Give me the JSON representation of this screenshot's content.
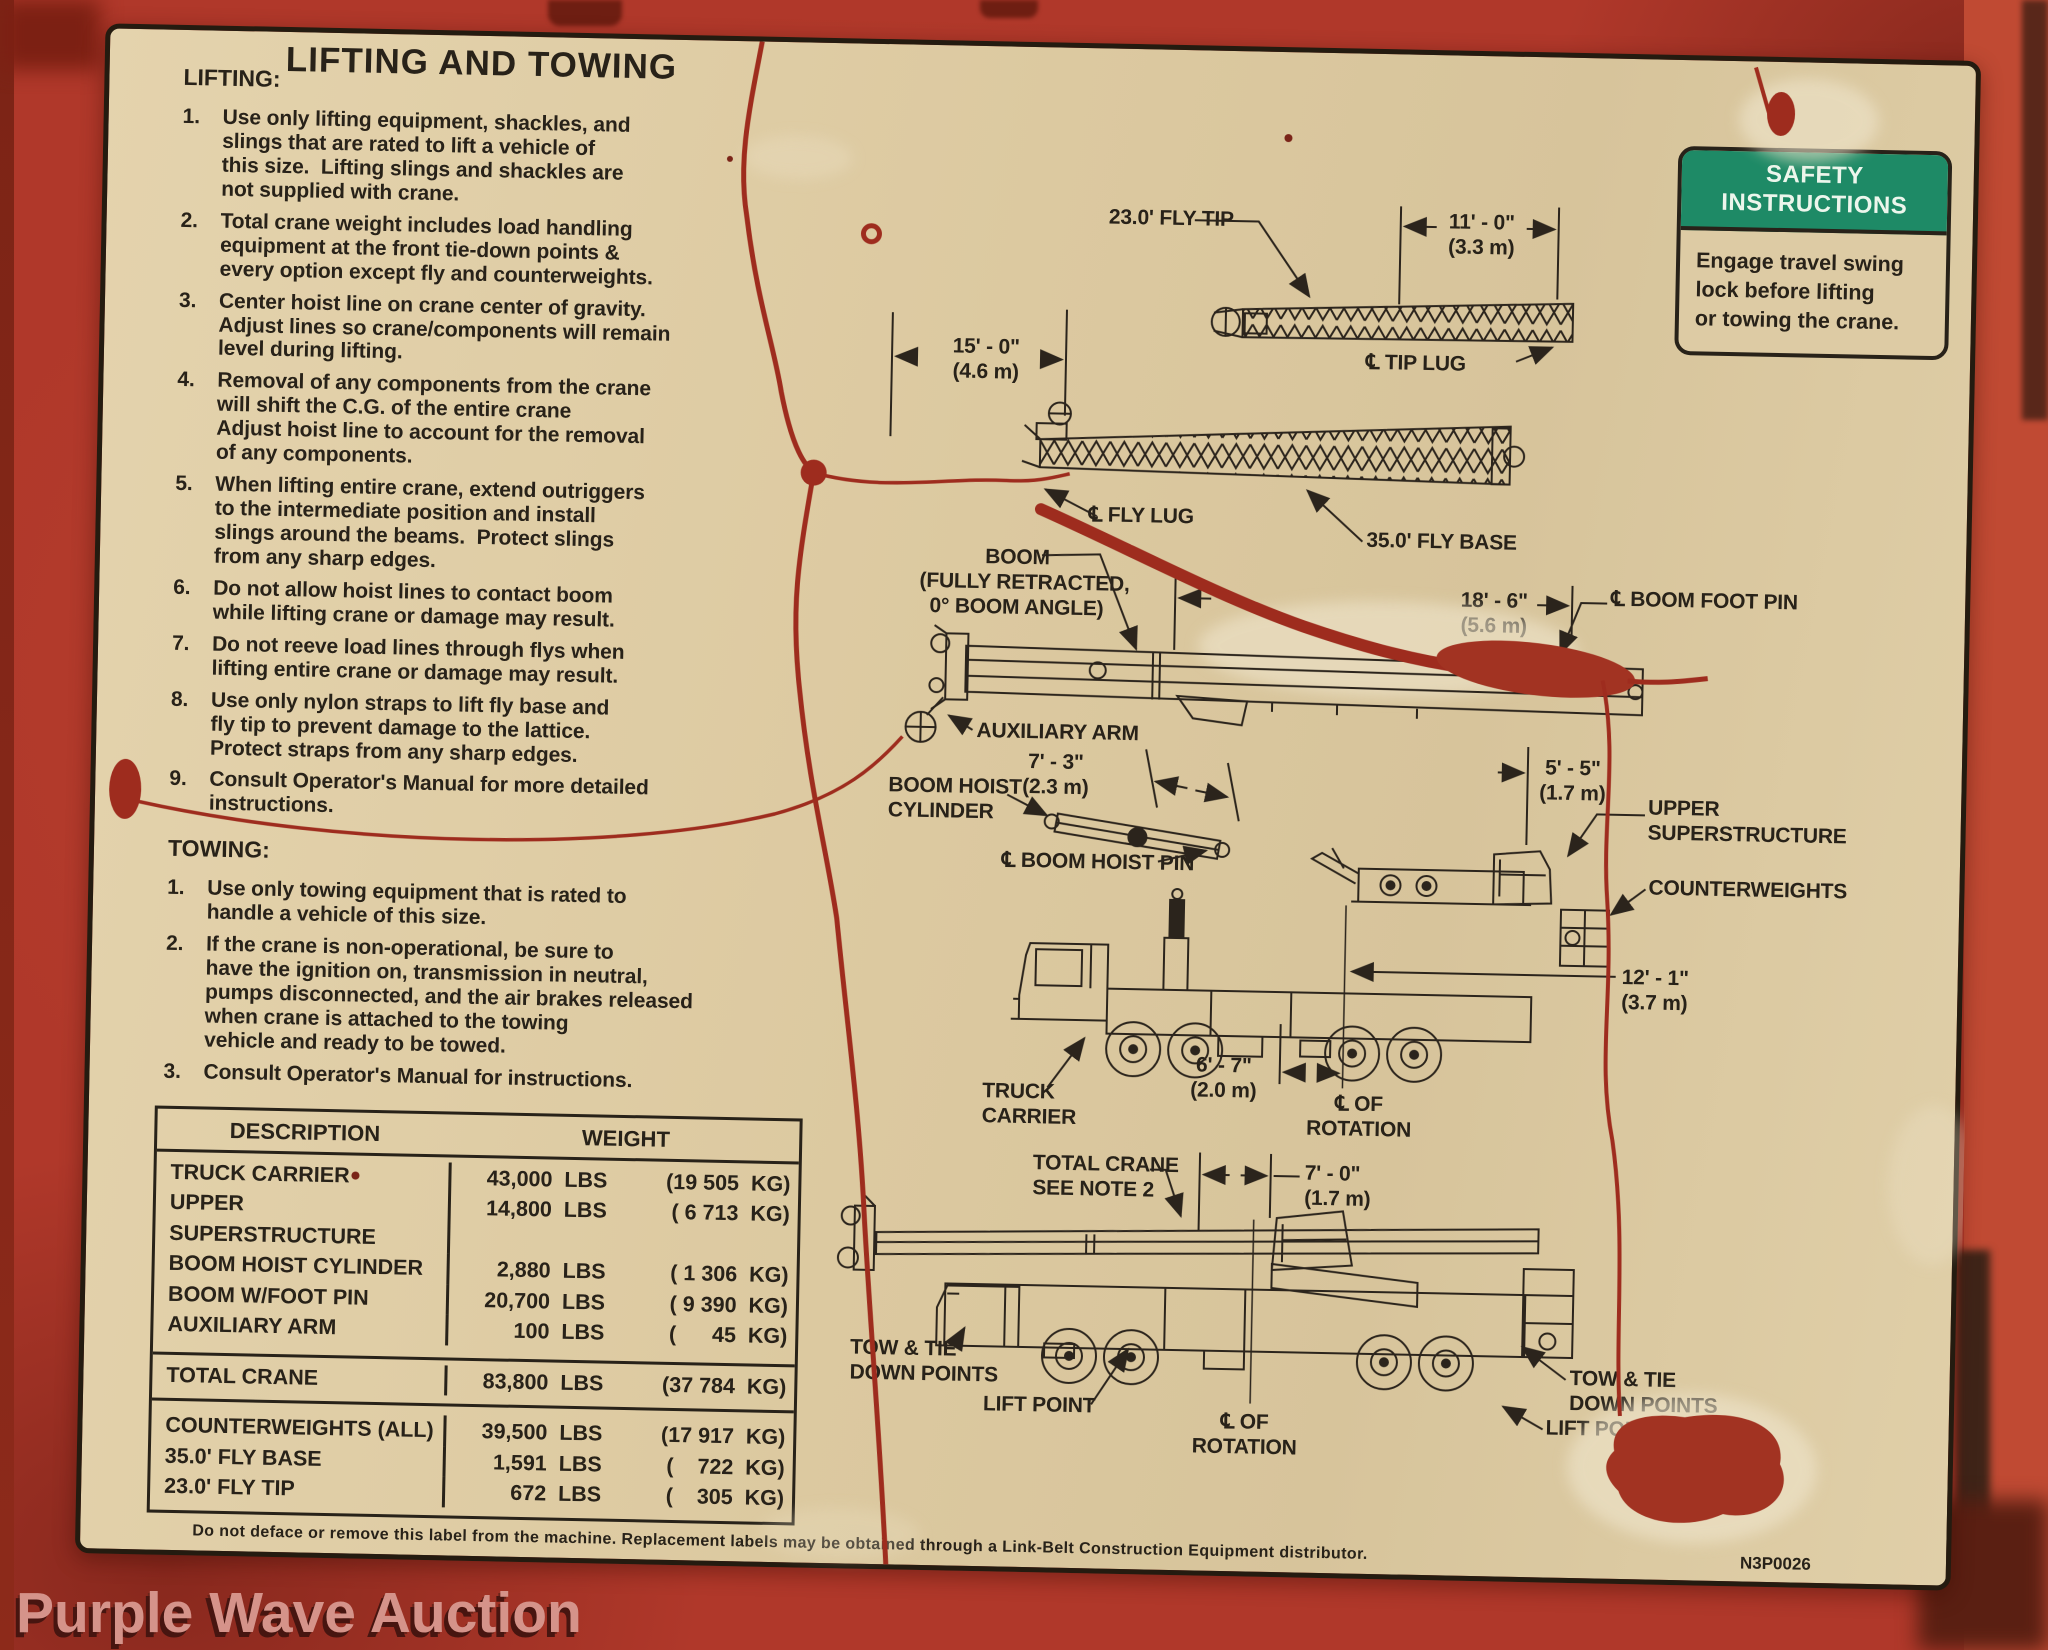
{
  "watermark": "Purple Wave Auction",
  "safety_box": {
    "title_line1": "SAFETY",
    "title_line2": "INSTRUCTIONS",
    "body": "Engage travel swing\nlock before lifting\nor towing the crane."
  },
  "panel": {
    "title": "LIFTING AND TOWING",
    "lifting_heading": "LIFTING:",
    "lifting_items": [
      {
        "n": "1.",
        "text": "Use only lifting equipment, shackles, and\nslings that are rated to lift a vehicle of\nthis size.  Lifting slings and shackles are\nnot supplied with crane."
      },
      {
        "n": "2.",
        "text": "Total crane weight includes load handling\nequipment at the front tie-down points &\nevery option except fly and counterweights."
      },
      {
        "n": "3.",
        "text": "Center hoist line on crane center of gravity.\nAdjust lines so crane/components will remain\nlevel during lifting."
      },
      {
        "n": "4.",
        "text": "Removal of any components from the crane\nwill shift the C.G. of the entire crane\nAdjust hoist line to account for the removal\nof any components."
      },
      {
        "n": "5.",
        "text": "When lifting entire crane, extend outriggers\nto the intermediate position and install\nslings around the beams.  Protect slings\nfrom any sharp edges."
      },
      {
        "n": "6.",
        "text": "Do not allow hoist lines to contact boom\nwhile lifting crane or damage may result."
      },
      {
        "n": "7.",
        "text": "Do not reeve load lines through flys when\nlifting entire crane or damage may result."
      },
      {
        "n": "8.",
        "text": "Use only nylon straps to lift fly base and\nfly tip to prevent damage to the lattice.\nProtect straps from any sharp edges."
      },
      {
        "n": "9.",
        "text": "Consult Operator's Manual for more detailed\ninstructions."
      }
    ],
    "towing_heading": "TOWING:",
    "towing_items": [
      {
        "n": "1.",
        "text": "Use only towing equipment that is rated to\nhandle a vehicle of this size."
      },
      {
        "n": "2.",
        "text": "If the crane is non-operational, be sure to\nhave the ignition on, transmission in neutral,\npumps disconnected, and the air brakes released\nwhen crane is attached to the towing\nvehicle and ready to be towed."
      },
      {
        "n": "3.",
        "text": "Consult Operator's Manual for instructions."
      }
    ],
    "table": {
      "col_desc": "DESCRIPTION",
      "col_weight": "WEIGHT",
      "rows": [
        {
          "desc": "TRUCK CARRIER",
          "lbs": "43,000  LBS",
          "kg": "(19 505  KG)"
        },
        {
          "desc": "UPPER SUPERSTRUCTURE",
          "lbs": "14,800  LBS",
          "kg": "( 6 713  KG)"
        },
        {
          "desc": "BOOM HOIST CYLINDER",
          "lbs": "2,880  LBS",
          "kg": "( 1 306  KG)"
        },
        {
          "desc": "BOOM W/FOOT PIN",
          "lbs": "20,700  LBS",
          "kg": "( 9 390  KG)"
        },
        {
          "desc": "AUXILIARY ARM",
          "lbs": "100  LBS",
          "kg": "(      45  KG)"
        },
        {
          "desc": "TOTAL CRANE",
          "lbs": "83,800  LBS",
          "kg": "(37 784  KG)"
        },
        {
          "desc": "COUNTERWEIGHTS (ALL)",
          "lbs": "39,500  LBS",
          "kg": "(17 917  KG)"
        },
        {
          "desc": "35.0' FLY BASE",
          "lbs": "1,591  LBS",
          "kg": "(    722  KG)"
        },
        {
          "desc": "23.0' FLY TIP",
          "lbs": "672  LBS",
          "kg": "(    305  KG)"
        }
      ]
    },
    "footnote": "Do not deface or remove this label from the machine.  Replacement labels may be obtained through a Link-Belt Construction Equipment distributor.",
    "part_number": "N3P0026"
  },
  "diagram": {
    "fly_tip_label": "23.0' FLY TIP",
    "dim_11_ft": "11' - 0\"",
    "dim_11_m": "(3.3 m)",
    "tip_lug": "℄  TIP LUG",
    "dim_15_ft": "15' - 0\"",
    "dim_15_m": "(4.6 m)",
    "fly_lug": "℄  FLY LUG",
    "fly_base_label": "35.0' FLY BASE",
    "boom_label_1": "BOOM",
    "boom_label_2": "(FULLY RETRACTED,",
    "boom_label_3": "0° BOOM ANGLE)",
    "dim_18_ft": "18' - 6\"",
    "dim_18_m": "(5.6 m)",
    "boom_foot_pin": "℄  BOOM FOOT PIN",
    "aux_arm": "AUXILIARY ARM",
    "boom_hoist_1": "BOOM HOIST",
    "boom_hoist_2": "CYLINDER",
    "dim_7_3_ft": "7' - 3\"",
    "dim_7_3_m": "(2.3 m)",
    "boom_hoist_pin": "℄  BOOM HOIST PIN",
    "dim_5_5_ft": "5' - 5\"",
    "dim_5_5_m": "(1.7 m)",
    "upper_1": "UPPER",
    "upper_2": "SUPERSTRUCTURE",
    "counterweights": "COUNTERWEIGHTS",
    "dim_12_1_ft": "12' - 1\"",
    "dim_12_1_m": "(3.7 m)",
    "dim_6_7_ft": "6' - 7\"",
    "dim_6_7_m": "(2.0 m)",
    "truck_1": "TRUCK",
    "truck_2": "CARRIER",
    "rot1_1": "℄ OF",
    "rot1_2": "ROTATION",
    "total_1": "TOTAL CRANE",
    "total_2": "SEE NOTE 2",
    "dim_7_0_ft": "7' - 0\"",
    "dim_7_0_m": "(1.7 m)",
    "tow_left_1": "TOW & TIE",
    "tow_left_2": "DOWN POINTS",
    "lift_left": "LIFT POINT",
    "rot2_1": "℄ OF",
    "rot2_2": "ROTATION",
    "tow_right_1": "TOW & TIE",
    "tow_right_2": "DOWN POINTS",
    "lift_right": "LIFT POI"
  }
}
